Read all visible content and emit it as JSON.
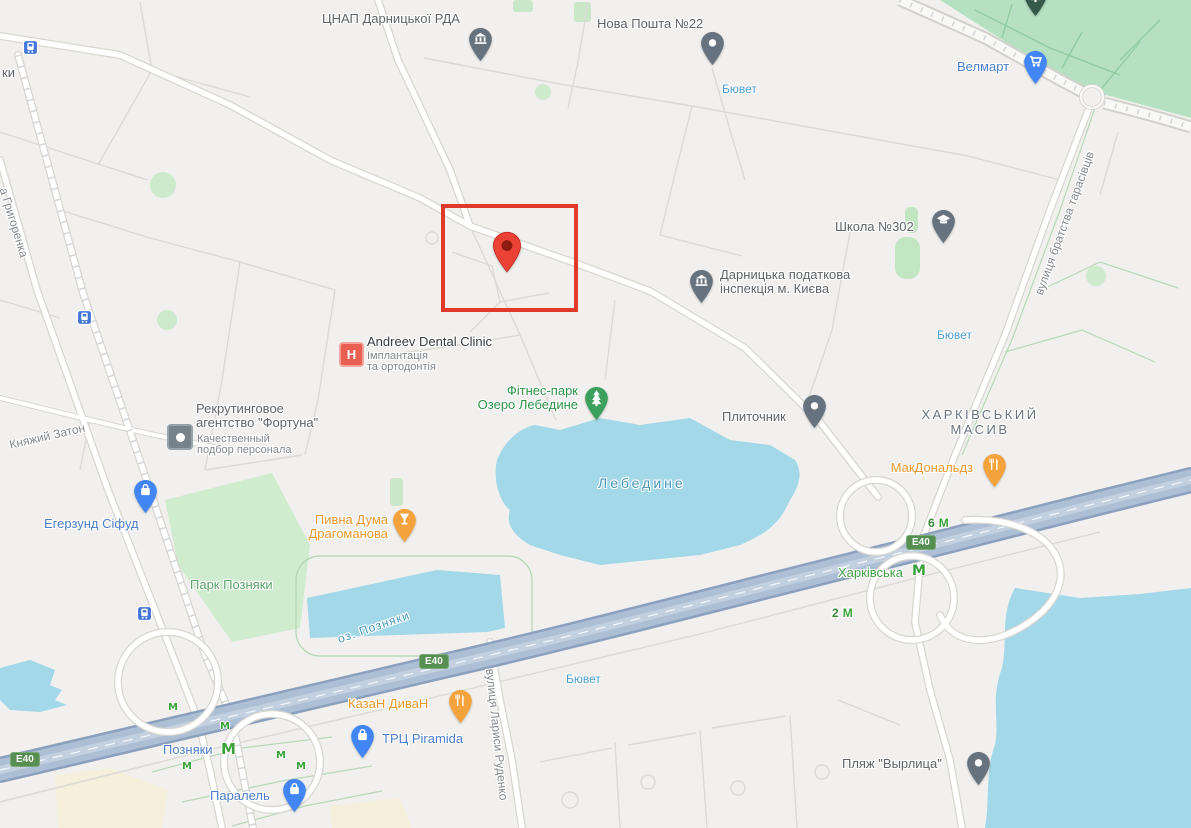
{
  "map": {
    "kind": "city-map-viewport",
    "city_area": "Pozniaky / Kharkivskyi, Kyiv"
  },
  "colors": {
    "background": "#f1f0ee",
    "water": "#a2d8e8",
    "park": "#cfeccf",
    "park_dense": "#b5e0c2",
    "highway_fill": "#adbfd4",
    "highway_casing": "#8ba0bc",
    "road_fill": "#ffffff",
    "poi_gray": "#5f6368",
    "poi_blue": "#4a7dc9",
    "poi_lightblue": "#4b9cd1",
    "poi_green": "#2d9248",
    "poi_orange": "#e8962e",
    "water_label": "#4796ba",
    "metro_green": "#3aa23a",
    "pin_red": "#ea4335",
    "highlight_red": "#e03a2a",
    "shield_green": "#568f52"
  },
  "icons": {
    "government_pin": "bank-columns",
    "post_pin": "white-dot",
    "cart_pin": "shopping-cart",
    "school_pin": "graduation-cap",
    "tree_pin": "fir-tree",
    "restaurant_pin": "fork-knife",
    "drink_pin": "goblet",
    "bag_pin": "shopping-bag",
    "dot_pin": "white-dot",
    "destination_pin": "red-teardrop",
    "transit_icon": "tram-in-blue-square",
    "hospital_icon": "red-square-H",
    "agency_icon": "gray-square-dot",
    "metro_icon": "green-M"
  },
  "pois": {
    "cnap": {
      "name": "ЦНАП Дарницької РДА"
    },
    "nova_poshta": {
      "name": "Нова Пошта №22"
    },
    "velmart": {
      "name": "Велмарт"
    },
    "byuvet_top": {
      "name": "Бювет"
    },
    "byuvet_right": {
      "name": "Бювет"
    },
    "byuvet_bottom": {
      "name": "Бювет"
    },
    "school": {
      "name": "Школа №302"
    },
    "tax_office": {
      "line1": "Дарницька податкова",
      "line2": "інспекція м. Києва"
    },
    "dental": {
      "name": "Andreev Dental Clinic",
      "subtitle_line1": "Імплантація",
      "subtitle_line2": "та ортодонтія"
    },
    "fortuna": {
      "line1": "Рекрутинговое",
      "line2": "агентство \"Фортуна\"",
      "subtitle_line1": "Качественный",
      "subtitle_line2": "подбор персонала"
    },
    "fitness_park": {
      "line1": "Фітнес-парк",
      "line2": "Озеро Лебедине"
    },
    "plytochnyk": {
      "name": "Плиточник"
    },
    "mcdonalds": {
      "name": "МакДональдз"
    },
    "egersund": {
      "name": "Егерзунд Сіфуд"
    },
    "pyvna_duma": {
      "line1": "Пивна Дума",
      "line2": "Драгоманова"
    },
    "kazan_divan": {
      "name": "КазаН ДиваН"
    },
    "piramida": {
      "name": "ТРЦ Piramida"
    },
    "parallel": {
      "name": "Паралель"
    },
    "beach": {
      "name": "Пляж \"Вырлица\""
    }
  },
  "areas": {
    "kharkivskyi_masyv": {
      "line1": "ХАРКІВСЬКИЙ",
      "line2": "МАСИВ"
    },
    "park_pozniaky": {
      "name": "Парк Позняки"
    }
  },
  "water": {
    "lebedyne": {
      "name": "Лебедине"
    },
    "lake_pozniaky": {
      "name": "оз. Позняки"
    }
  },
  "streets": {
    "larysy_rudenko": "вулиця Лариси Руденко",
    "bratstva_tarasivtsiv": "вулиця братства тарасівців",
    "kniazhyi_zaton": "Княжий Затон",
    "hryhorenka": "а Григоренка",
    "partial_ky": "ки"
  },
  "metro": {
    "pozniaky": "Позняки",
    "kharkivska": "Харківська",
    "m": "М",
    "exit_6": "6",
    "exit_2": "2"
  },
  "road_shields": {
    "e40": "E40"
  }
}
